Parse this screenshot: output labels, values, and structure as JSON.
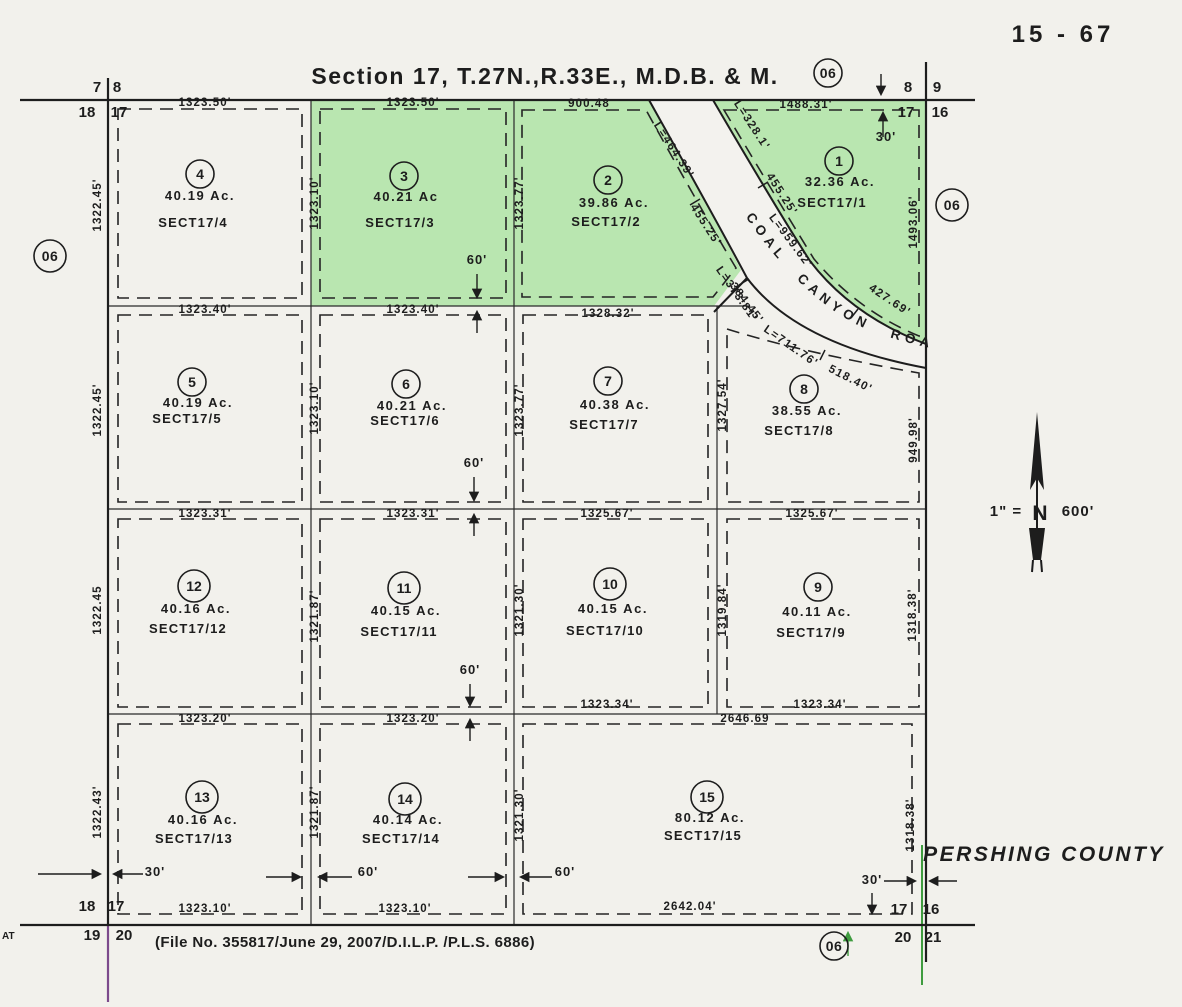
{
  "sheet": {
    "number": "15 - 67",
    "title": "Section 17, T.27N.,R.33E., M.D.B. & M.",
    "file_note": "(File No. 355817/June 29, 2007/D.I.L.P. /P.L.S. 6886)",
    "county": "PERSHING COUNTY",
    "edge_text": "AT"
  },
  "scale": {
    "prefix": "1\" =",
    "north": "N",
    "suffix": "600'"
  },
  "colors": {
    "paper": "#f2f1ec",
    "parcel_green": "#b9e6b0",
    "ink": "#1d1d1d",
    "green_line": "#3f9c3f",
    "purple_line": "#7c4a8c"
  },
  "road": {
    "name": "COAL CANYON ROAD",
    "labels": [
      {
        "t": "L=464.39'",
        "x": 671,
        "y": 152,
        "r": 57
      },
      {
        "t": "455.25'",
        "x": 703,
        "y": 227,
        "r": 57
      },
      {
        "t": "L=373.81'",
        "x": 734,
        "y": 296,
        "r": 55
      },
      {
        "t": "L=328.1'",
        "x": 749,
        "y": 127,
        "r": 57
      },
      {
        "t": "455.25'",
        "x": 779,
        "y": 196,
        "r": 57
      },
      {
        "t": "L=959.62'",
        "x": 788,
        "y": 243,
        "r": 53
      },
      {
        "t": "427.69'",
        "x": 888,
        "y": 303,
        "r": 34
      },
      {
        "t": "384.45'",
        "x": 744,
        "y": 305,
        "r": 53
      },
      {
        "t": "L=711.76'",
        "x": 789,
        "y": 349,
        "r": 35
      },
      {
        "t": "518.40'",
        "x": 849,
        "y": 382,
        "r": 27
      }
    ]
  },
  "green_parcels": [
    "1",
    "2",
    "3"
  ],
  "parcels": [
    {
      "num": "1",
      "acres": "32.36 Ac.",
      "sect": "SECT17/1",
      "cx": 839,
      "cy": 161,
      "ax": 840,
      "ay": 186,
      "sx": 832,
      "sy": 207
    },
    {
      "num": "2",
      "acres": "39.86 Ac.",
      "sect": "SECT17/2",
      "cx": 608,
      "cy": 180,
      "ax": 614,
      "ay": 207,
      "sx": 606,
      "sy": 226
    },
    {
      "num": "3",
      "acres": "40.21 Ac",
      "sect": "SECT17/3",
      "cx": 404,
      "cy": 176,
      "ax": 406,
      "ay": 201,
      "sx": 400,
      "sy": 227
    },
    {
      "num": "4",
      "acres": "40.19 Ac.",
      "sect": "SECT17/4",
      "cx": 200,
      "cy": 174,
      "ax": 200,
      "ay": 200,
      "sx": 193,
      "sy": 227
    },
    {
      "num": "5",
      "acres": "40.19 Ac.",
      "sect": "SECT17/5",
      "cx": 192,
      "cy": 382,
      "ax": 198,
      "ay": 407,
      "sx": 187,
      "sy": 423
    },
    {
      "num": "6",
      "acres": "40.21 Ac.",
      "sect": "SECT17/6",
      "cx": 406,
      "cy": 384,
      "ax": 412,
      "ay": 410,
      "sx": 405,
      "sy": 425
    },
    {
      "num": "7",
      "acres": "40.38 Ac.",
      "sect": "SECT17/7",
      "cx": 608,
      "cy": 381,
      "ax": 615,
      "ay": 409,
      "sx": 604,
      "sy": 429
    },
    {
      "num": "8",
      "acres": "38.55 Ac.",
      "sect": "SECT17/8",
      "cx": 804,
      "cy": 389,
      "ax": 807,
      "ay": 415,
      "sx": 799,
      "sy": 435
    },
    {
      "num": "9",
      "acres": "40.11 Ac.",
      "sect": "SECT17/9",
      "cx": 818,
      "cy": 587,
      "ax": 817,
      "ay": 616,
      "sx": 811,
      "sy": 637
    },
    {
      "num": "10",
      "acres": "40.15 Ac.",
      "sect": "SECT17/10",
      "cx": 610,
      "cy": 584,
      "ax": 613,
      "ay": 613,
      "sx": 605,
      "sy": 635
    },
    {
      "num": "11",
      "acres": "40.15 Ac.",
      "sect": "SECT17/11",
      "cx": 404,
      "cy": 588,
      "ax": 406,
      "ay": 615,
      "sx": 399,
      "sy": 636
    },
    {
      "num": "12",
      "acres": "40.16 Ac.",
      "sect": "SECT17/12",
      "cx": 194,
      "cy": 586,
      "ax": 196,
      "ay": 613,
      "sx": 188,
      "sy": 633
    },
    {
      "num": "13",
      "acres": "40.16 Ac.",
      "sect": "SECT17/13",
      "cx": 202,
      "cy": 797,
      "ax": 203,
      "ay": 824,
      "sx": 194,
      "sy": 843
    },
    {
      "num": "14",
      "acres": "40.14 Ac.",
      "sect": "SECT17/14",
      "cx": 405,
      "cy": 799,
      "ax": 408,
      "ay": 824,
      "sx": 401,
      "sy": 843
    },
    {
      "num": "15",
      "acres": "80.12 Ac.",
      "sect": "SECT17/15",
      "cx": 707,
      "cy": 797,
      "ax": 710,
      "ay": 822,
      "sx": 703,
      "sy": 840
    }
  ],
  "dimensions": [
    {
      "t": "1323.50'",
      "x": 205,
      "y": 106,
      "r": 0
    },
    {
      "t": "1323.50'",
      "x": 413,
      "y": 106,
      "r": 0
    },
    {
      "t": "900.48",
      "x": 589,
      "y": 107,
      "r": 0
    },
    {
      "t": "1488.31'",
      "x": 806,
      "y": 108,
      "r": 0
    },
    {
      "t": "1323.40'",
      "x": 205,
      "y": 313,
      "r": 0
    },
    {
      "t": "1323.40'",
      "x": 413,
      "y": 313,
      "r": 0
    },
    {
      "t": "1328.32'",
      "x": 608,
      "y": 317,
      "r": 0
    },
    {
      "t": "1323.31'",
      "x": 205,
      "y": 517,
      "r": 0
    },
    {
      "t": "1323.31'",
      "x": 413,
      "y": 517,
      "r": 0
    },
    {
      "t": "1325.67'",
      "x": 607,
      "y": 517,
      "r": 0
    },
    {
      "t": "1325.67'",
      "x": 812,
      "y": 517,
      "r": 0
    },
    {
      "t": "1323.20'",
      "x": 205,
      "y": 722,
      "r": 0
    },
    {
      "t": "1323.20'",
      "x": 413,
      "y": 722,
      "r": 0
    },
    {
      "t": "1323.34'",
      "x": 607,
      "y": 708,
      "r": 0
    },
    {
      "t": "1323.34'",
      "x": 820,
      "y": 708,
      "r": 0
    },
    {
      "t": "2646.69",
      "x": 745,
      "y": 722,
      "r": 0
    },
    {
      "t": "1323.10'",
      "x": 205,
      "y": 912,
      "r": 0
    },
    {
      "t": "1323.10'",
      "x": 405,
      "y": 912,
      "r": 0
    },
    {
      "t": "2642.04'",
      "x": 690,
      "y": 910,
      "r": 0
    },
    {
      "t": "1322.45'",
      "x": 101,
      "y": 205,
      "r": -90
    },
    {
      "t": "1323.10'",
      "x": 318,
      "y": 203,
      "r": -90
    },
    {
      "t": "1323.77'",
      "x": 523,
      "y": 203,
      "r": -90
    },
    {
      "t": "1493.06'",
      "x": 917,
      "y": 222,
      "r": -90
    },
    {
      "t": "1322.45'",
      "x": 101,
      "y": 410,
      "r": -90
    },
    {
      "t": "1323.10'",
      "x": 318,
      "y": 408,
      "r": -90
    },
    {
      "t": "1323.77'",
      "x": 523,
      "y": 410,
      "r": -90
    },
    {
      "t": "1327.54'",
      "x": 726,
      "y": 405,
      "r": -90
    },
    {
      "t": "949.98'",
      "x": 917,
      "y": 440,
      "r": -90
    },
    {
      "t": "1322.45",
      "x": 101,
      "y": 610,
      "r": -90
    },
    {
      "t": "1321.87'",
      "x": 318,
      "y": 616,
      "r": -90
    },
    {
      "t": "1321.30'",
      "x": 523,
      "y": 610,
      "r": -90
    },
    {
      "t": "1319.84'",
      "x": 726,
      "y": 610,
      "r": -90
    },
    {
      "t": "1318.38'",
      "x": 916,
      "y": 615,
      "r": -90
    },
    {
      "t": "1322.43'",
      "x": 101,
      "y": 812,
      "r": -90
    },
    {
      "t": "1321.87'",
      "x": 318,
      "y": 812,
      "r": -90
    },
    {
      "t": "1321.30'",
      "x": 523,
      "y": 815,
      "r": -90
    },
    {
      "t": "1318.38'",
      "x": 914,
      "y": 825,
      "r": -90
    }
  ],
  "annotations": [
    {
      "t": "60'",
      "x": 477,
      "y": 264
    },
    {
      "t": "60'",
      "x": 474,
      "y": 467
    },
    {
      "t": "60'",
      "x": 470,
      "y": 674
    },
    {
      "t": "30'",
      "x": 886,
      "y": 141
    },
    {
      "t": "30'",
      "x": 155,
      "y": 876
    },
    {
      "t": "60'",
      "x": 368,
      "y": 876
    },
    {
      "t": "60'",
      "x": 565,
      "y": 876
    },
    {
      "t": "30'",
      "x": 872,
      "y": 884
    }
  ],
  "ref_circles": [
    {
      "t": "06",
      "x": 828,
      "y": 73,
      "rr": 14
    },
    {
      "t": "06",
      "x": 952,
      "y": 205,
      "rr": 16
    },
    {
      "t": "06",
      "x": 50,
      "y": 256,
      "rr": 16
    },
    {
      "t": "06",
      "x": 834,
      "y": 946,
      "rr": 14
    }
  ],
  "corner_labels": [
    {
      "t": "7",
      "x": 97,
      "y": 92
    },
    {
      "t": "8",
      "x": 117,
      "y": 92
    },
    {
      "t": "18",
      "x": 87,
      "y": 117
    },
    {
      "t": "17",
      "x": 119,
      "y": 117
    },
    {
      "t": "8",
      "x": 908,
      "y": 92
    },
    {
      "t": "9",
      "x": 937,
      "y": 92
    },
    {
      "t": "17",
      "x": 906,
      "y": 117
    },
    {
      "t": "16",
      "x": 940,
      "y": 117
    },
    {
      "t": "18",
      "x": 87,
      "y": 911
    },
    {
      "t": "17",
      "x": 116,
      "y": 911
    },
    {
      "t": "19",
      "x": 92,
      "y": 940
    },
    {
      "t": "20",
      "x": 124,
      "y": 940
    },
    {
      "t": "17",
      "x": 899,
      "y": 914
    },
    {
      "t": "16",
      "x": 931,
      "y": 914
    },
    {
      "t": "20",
      "x": 903,
      "y": 942
    },
    {
      "t": "21",
      "x": 933,
      "y": 942
    }
  ]
}
